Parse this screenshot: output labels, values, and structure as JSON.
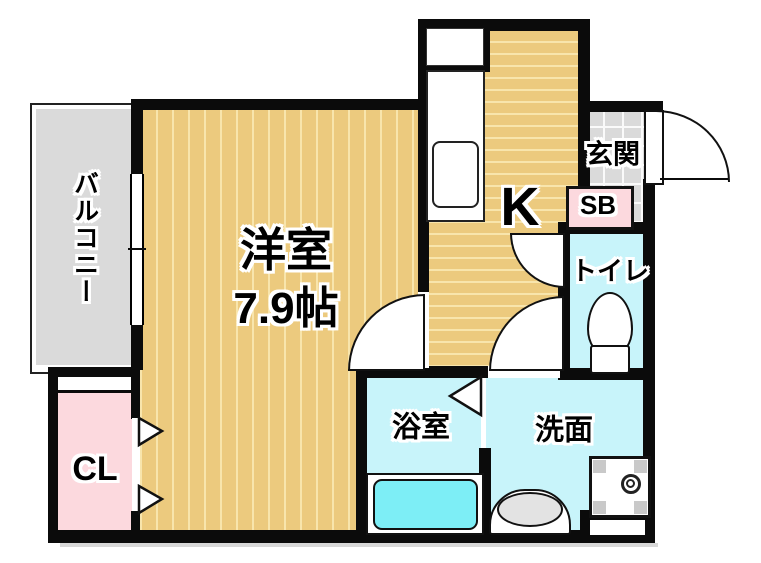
{
  "floorplan": {
    "rooms": {
      "balcony": {
        "label": "バルコニー"
      },
      "western_room": {
        "label": "洋室",
        "size": "7.9帖"
      },
      "kitchen": {
        "label": "K"
      },
      "entrance": {
        "label": "玄関"
      },
      "shoe_box": {
        "label": "SB"
      },
      "toilet": {
        "label": "トイレ"
      },
      "bathroom": {
        "label": "浴室"
      },
      "washroom": {
        "label": "洗面"
      },
      "closet": {
        "label": "CL"
      }
    },
    "colors": {
      "wall": "#0b0b0b",
      "wood_floor": "#ecca7e",
      "floor_stripe": "#f8e5ac",
      "tile_gray": "#dadada",
      "wet_room_cyan": "#c8f4fa",
      "bathtub_cyan": "#7deef6",
      "storage_pink": "#fcd9de",
      "fixture_white": "#ffffff"
    }
  }
}
